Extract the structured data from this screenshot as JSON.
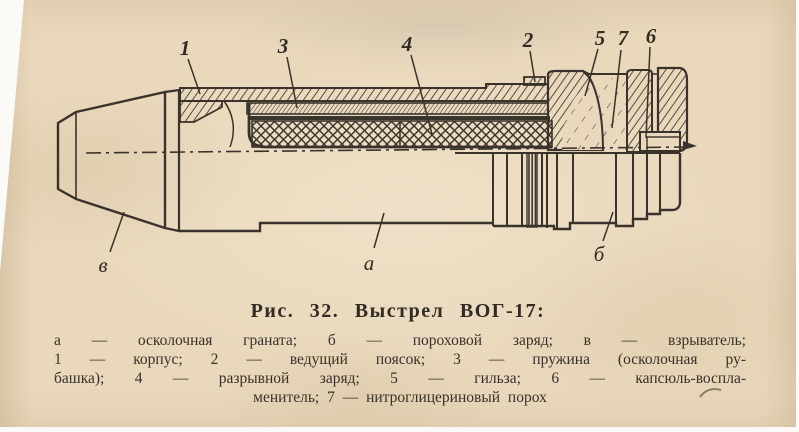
{
  "figure": {
    "caption": "Рис. 32. Выстрел ВОГ-17:",
    "legend_lines": [
      "а — осколочная граната; б — пороховой заряд; в — взрыватель;",
      "1 — корпус; 2 — ведущий поясок; 3 — пружина (осколочная ру-",
      "башка); 4 — разрывной заряд; 5 — гильза; 6 — капсюль-воспла-",
      "менитель; 7 — нитроглицериновый порох"
    ],
    "callouts": {
      "n1": "1",
      "n2": "2",
      "n3": "3",
      "n4": "4",
      "n5": "5",
      "n6": "6",
      "n7": "7",
      "a": "а",
      "b": "б",
      "v": "в"
    },
    "colors": {
      "paper": "#e9d8bc",
      "ink": "#3a332b",
      "margin_white": "#fbfaf7"
    }
  }
}
